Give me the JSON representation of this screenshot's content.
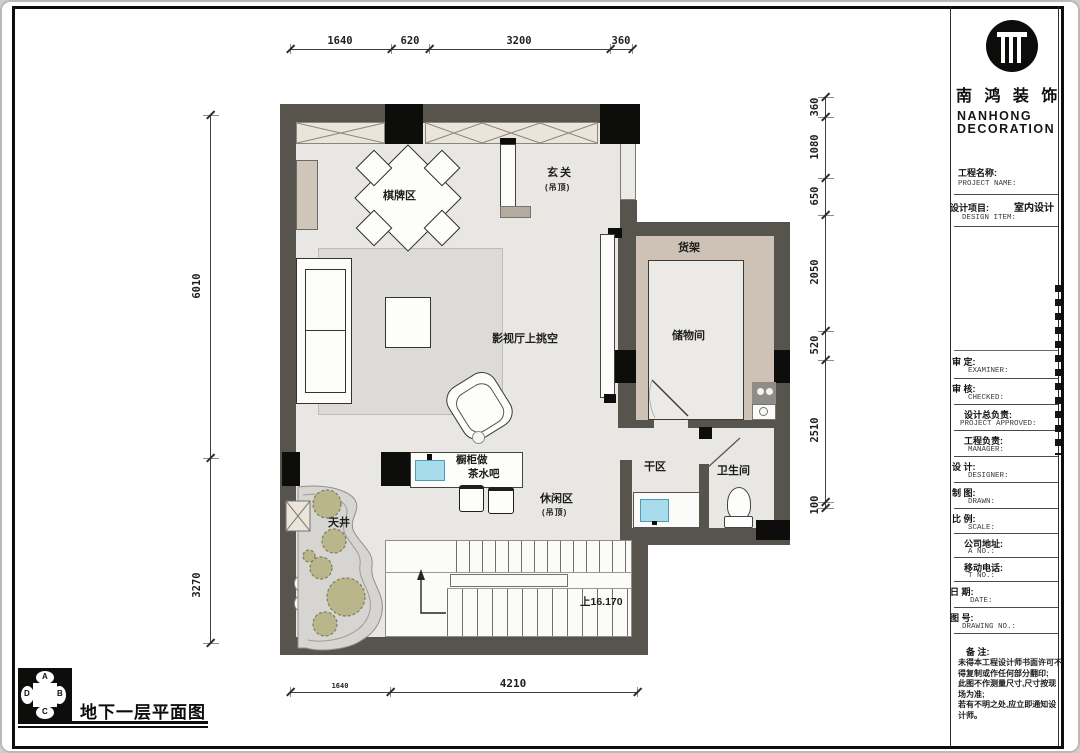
{
  "sheet": {
    "floor_title": "地下一层平面图"
  },
  "compass": {
    "n": "A",
    "e": "B",
    "s": "C",
    "w": "D"
  },
  "brand": {
    "cn": "南 鸿 装 饰",
    "en_line1": "NANHONG",
    "en_line2": "DECORATION"
  },
  "titleblock": {
    "project_cn": "工程名称:",
    "project_en": "PROJECT NAME:",
    "item_cn": "设计项目:",
    "item_en": "DESIGN ITEM:",
    "item_value": "室内设计",
    "rows": [
      {
        "cn": "审  定:",
        "en": "EXAMINER:"
      },
      {
        "cn": "审  核:",
        "en": "CHECKED:"
      },
      {
        "cn": "设计总负责:",
        "en": "PROJECT APPROVED:"
      },
      {
        "cn": "工程负责:",
        "en": "MANAGER:"
      },
      {
        "cn": "设  计:",
        "en": "DESIGNER:"
      },
      {
        "cn": "制  图:",
        "en": "DRAWN:"
      },
      {
        "cn": "比  例:",
        "en": "SCALE:"
      },
      {
        "cn": "公司地址:",
        "en": "A  NO.:"
      },
      {
        "cn": "移动电话:",
        "en": "T  NO.:"
      },
      {
        "cn": "日  期:",
        "en": "DATE:"
      },
      {
        "cn": "图  号:",
        "en": "DRAWING NO.:"
      }
    ],
    "remark_cn": "备  注:",
    "remark_lines": [
      "未得本工程设计师书面许可不",
      "得复制或作任何部分翻印;",
      "此图不作测量尺寸,尺寸按现",
      "场为准;",
      "若有不明之处,应立即通知设",
      "计师。"
    ]
  },
  "rooms": {
    "chess": "棋牌区",
    "entry": "玄关",
    "entry_sub": "(吊顶)",
    "shelf": "货架",
    "storage": "储物间",
    "void": "影视厅上挑空",
    "dry": "干区",
    "bath": "卫生间",
    "leisure": "休闲区",
    "leisure_sub": "(吊顶)",
    "bar1": "橱柜做",
    "bar2": "茶水吧",
    "lightwell": "天井",
    "stair_up": "上16.170"
  },
  "dims": {
    "top": [
      "1640",
      "620",
      "3200",
      "360"
    ],
    "left": [
      "6010",
      "3270"
    ],
    "right": [
      "360",
      "1080",
      "650",
      "2050",
      "520",
      "2510",
      "100"
    ],
    "bottom": [
      "1640",
      "4210"
    ]
  }
}
